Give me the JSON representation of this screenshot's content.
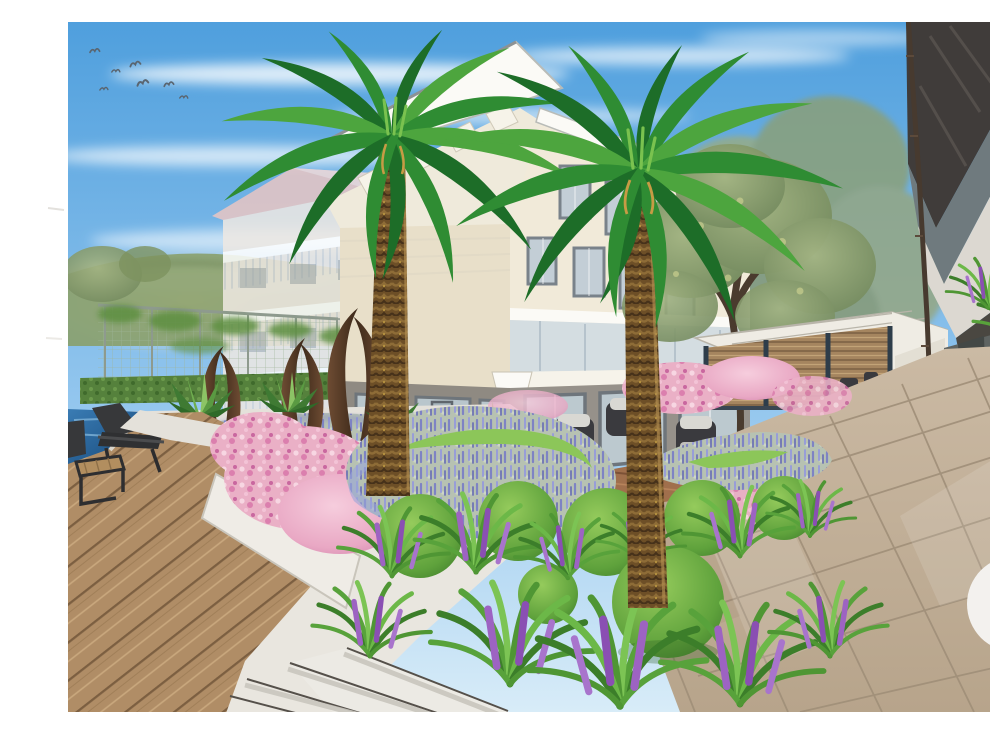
{
  "meta": {
    "kind": "architectural landscape rendering",
    "description": "Hand-drawn style visualization of a resort courtyard garden: two date palms in a planted bed of lavender, azaleas, clipped boxwood balls and liriope grasses, in front of a modern cream apartment building; wooden pool deck with lounge chair at left, louvered garden pavilion and stone tile walkway at right",
    "visible_text": ""
  },
  "palette": {
    "paper": "#ffffff",
    "skyTop": "#4f9fdd",
    "skyLow": "#cfe7f7",
    "glow": "#f8dfbd",
    "hill": "#8aa06b",
    "hedge": "#55813c",
    "wallLight": "#d8d6ce",
    "bldgCream": "#f1ead9",
    "bldgShadow": "#e3d9c3",
    "bldgBase": "#96918a",
    "roofWhite": "#fafaf4",
    "roofTrim": "#a8adae",
    "winGlass": "#c3ced6",
    "winFrame": "#79828a",
    "pinkRoof": "#e9c6c4",
    "leftBldg": "#efe9e3",
    "darkRoof": "#403c3a",
    "soffit": "#dcd8d1",
    "rightWall": "#5f6462",
    "gutter": "#473a2f",
    "pavWood": "#a5855f",
    "pavFrame": "#2e3d4a",
    "pavWhite": "#efece4",
    "deck": "#b08d66",
    "pool": "#2a6ea6",
    "path": "#e4e1da",
    "stepEdge": "#55504a",
    "tile": "#c3b199",
    "tileJoint": "#a08f79",
    "lavFoliage": "#b7c2b2",
    "lavBloom": "#7e83c4",
    "pink": "#eab0c6",
    "boxwood": "#6fb04a",
    "liriope": "#9d63c2",
    "rust": "#5d4133",
    "palmGreen": "#2f8c33",
    "trunk": "#6d4f27",
    "chair": "#3a3a3e",
    "cushion": "#d9d8d3",
    "treeOlive": "#8d9f72",
    "bird": "#5a6570"
  },
  "scene": {
    "counts": {
      "birds": 7,
      "palms": 2,
      "arc_sculptures": 3,
      "steps": 4,
      "boxwood_balls": 7
    },
    "labels": {
      "image": "resort courtyard garden rendering",
      "sky": "blue sky with cirrus clouds",
      "birds": "flock of birds",
      "hill": "green hillside",
      "leftBuilding": "background apartment block with pink roof",
      "fence": "tennis court fence with climbing plants",
      "hedge": "clipped hedge row",
      "mainBuilding": "cream three storey building with glazed ground floor",
      "tree": "deciduous courtyard tree",
      "pavilion": "louvered timber garden pavilion",
      "rightBuilding": "foreground building with dark roof overhang",
      "arcs": "corten steel arc sculptures",
      "pool": "swimming pool edge",
      "deck": "timber pool deck",
      "chaise": "sun lounger",
      "sideTable": "timber side table",
      "path": "concrete garden path",
      "steps": "garden steps",
      "planter": "raised white planter wall",
      "pinkBed": "pink azalea planting",
      "lavender": "lavender swirl planting",
      "boxwood": "clipped boxwood balls",
      "liriope": "liriope grass clumps",
      "seating": "outdoor lounge seating set",
      "palmLeft": "date palm left",
      "palmRight": "date palm right",
      "tiles": "stone tile walkway",
      "watermark": "faint paper watermark"
    }
  }
}
